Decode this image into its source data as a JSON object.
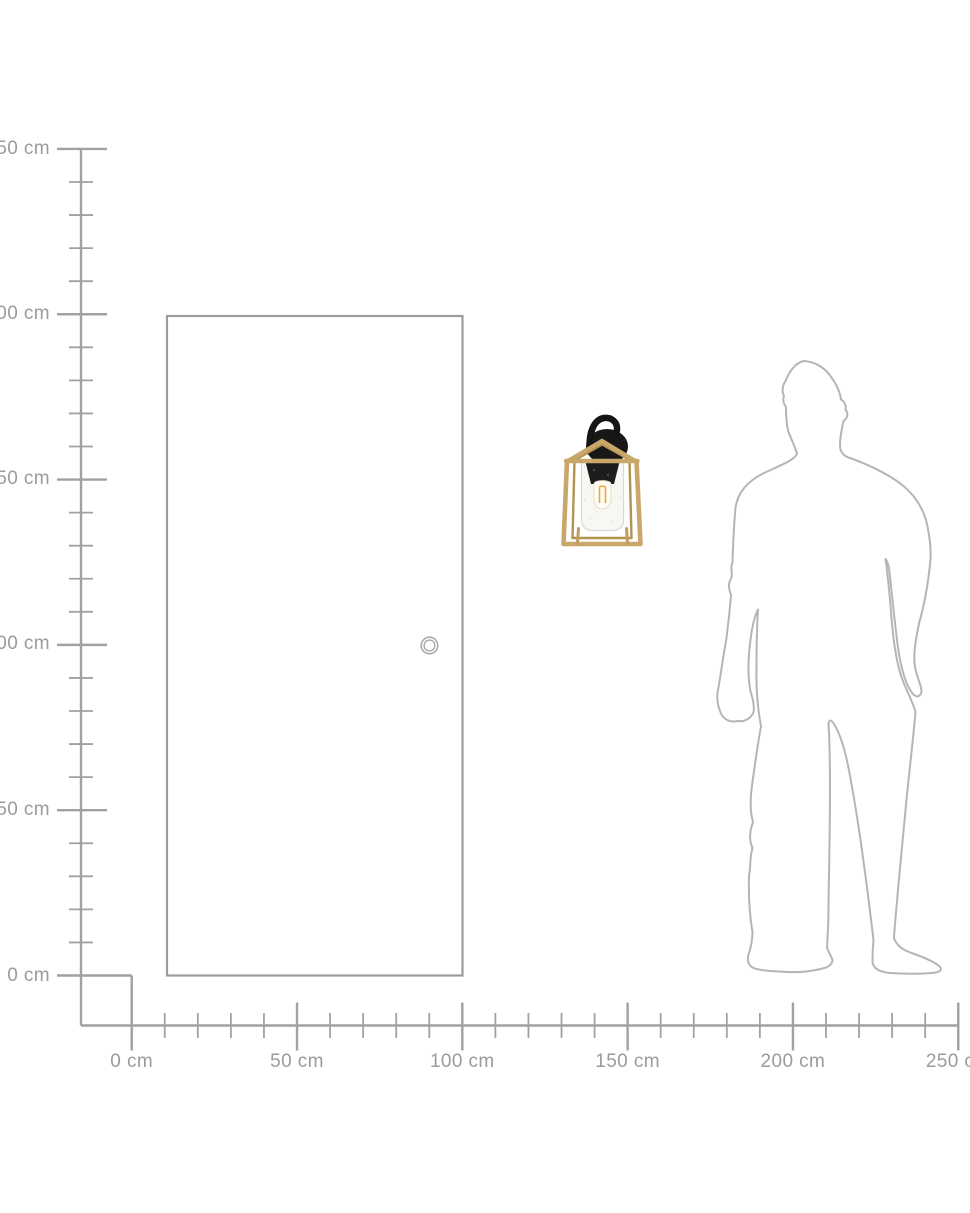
{
  "page": {
    "background": "#ffffff"
  },
  "rulers": {
    "unit": "cm",
    "max_cm": 250,
    "major_step_cm": 50,
    "minor_step_cm": 10,
    "line_color": "#a1a1a1",
    "label_color": "#9b9b9b",
    "y_axis": {
      "labels": [
        "250 cm",
        "200 cm",
        "150 cm",
        "100 cm",
        "50 cm",
        "0 cm"
      ]
    },
    "x_axis": {
      "labels": [
        "0 cm",
        "50 cm",
        "100 cm",
        "150 cm",
        "200 cm",
        "250 cm"
      ]
    }
  },
  "objects": {
    "door": {
      "name": "door outline with knob",
      "outline_color": "#9c9c9c"
    },
    "lamp": {
      "name": "wall lantern light, black mount with brass cage, glass shade and filament bulb",
      "brass_color": "#c9a76a",
      "black_color": "#1a1a1a",
      "glass_color": "#f6f6f3",
      "filament_color": "#e8a93c"
    },
    "person": {
      "name": "standing man silhouette outline",
      "outline_color": "#b5b5b5"
    }
  }
}
